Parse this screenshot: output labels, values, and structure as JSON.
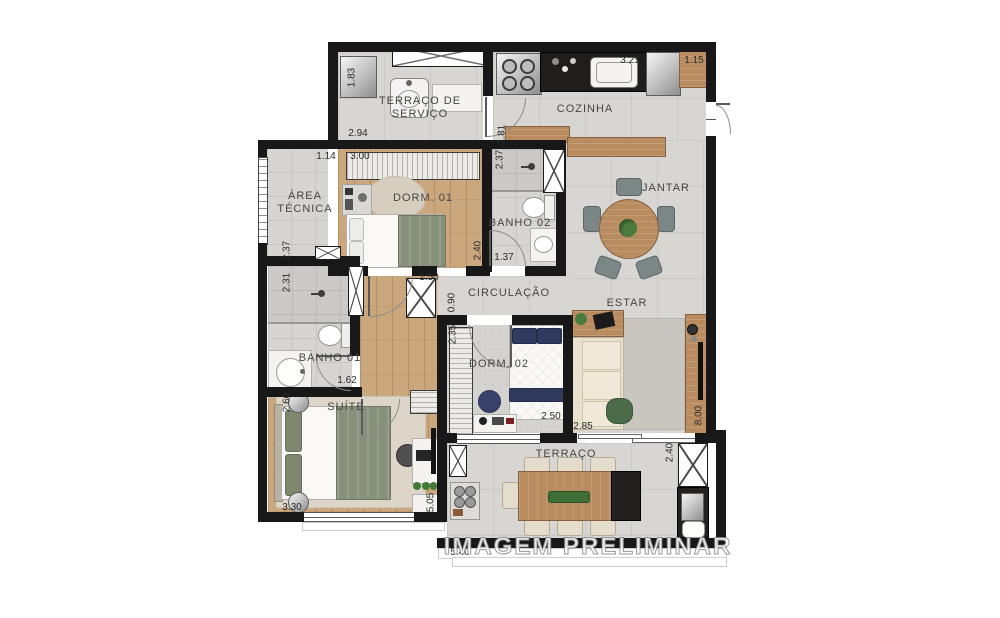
{
  "watermark": "IMAGEM PRELIMINAR",
  "palette": {
    "wall": "#181818",
    "floor_tile": "#d8d6d2",
    "floor_wood": "#cba77d",
    "furniture_wood": "#b98c60",
    "counter_dark": "#201e1c",
    "bedding_sage": "#87907a",
    "bedding_navy": "#2f3a5e",
    "sofa_cream": "#e9e1ce",
    "chair_gray": "#7b8686",
    "plant_green": "#4a7c3f"
  },
  "rooms": {
    "terraco_servico": {
      "label": "TERRAÇO DE SERVIÇO"
    },
    "cozinha": {
      "label": "COZINHA"
    },
    "jantar": {
      "label": "JANTAR"
    },
    "area_tecnica": {
      "label": "ÁREA TÉCNICA"
    },
    "dorm01": {
      "label": "DORM. 01"
    },
    "banho02": {
      "label": "BANHO 02"
    },
    "circulacao": {
      "label": "CIRCULAÇÃO"
    },
    "estar": {
      "label": "ESTAR"
    },
    "banho01": {
      "label": "BANHO 01"
    },
    "dorm02": {
      "label": "DORM. 02"
    },
    "suite": {
      "label": "SUÍTE"
    },
    "terraco": {
      "label": "TERRAÇO"
    }
  },
  "dims": {
    "ts_height": "1.83",
    "ts_width": "2.94",
    "cozinha_width_1": "3.21",
    "cozinha_width_2": "1.15",
    "cozinha_height": "1.81",
    "area_tecnica_width": "1.14",
    "area_tecnica_height": "2.37",
    "dorm01_width": "3.00",
    "dorm01_height": "2.40",
    "banho02_height": "2.37",
    "banho02_width": "1.37",
    "circ_width": "1.50",
    "circ_height": "0.90",
    "banho01_height": "2.31",
    "banho01_width": "1.62",
    "dorm02_height": "2.35",
    "dorm02_width": "2.50",
    "estar_width": "2.85",
    "estar_height": "8.00",
    "suite_height": "2.60",
    "suite_width": "3.30",
    "suite_side": "5.05",
    "terraco_height": "2.40",
    "terraco_width": "5.40"
  }
}
